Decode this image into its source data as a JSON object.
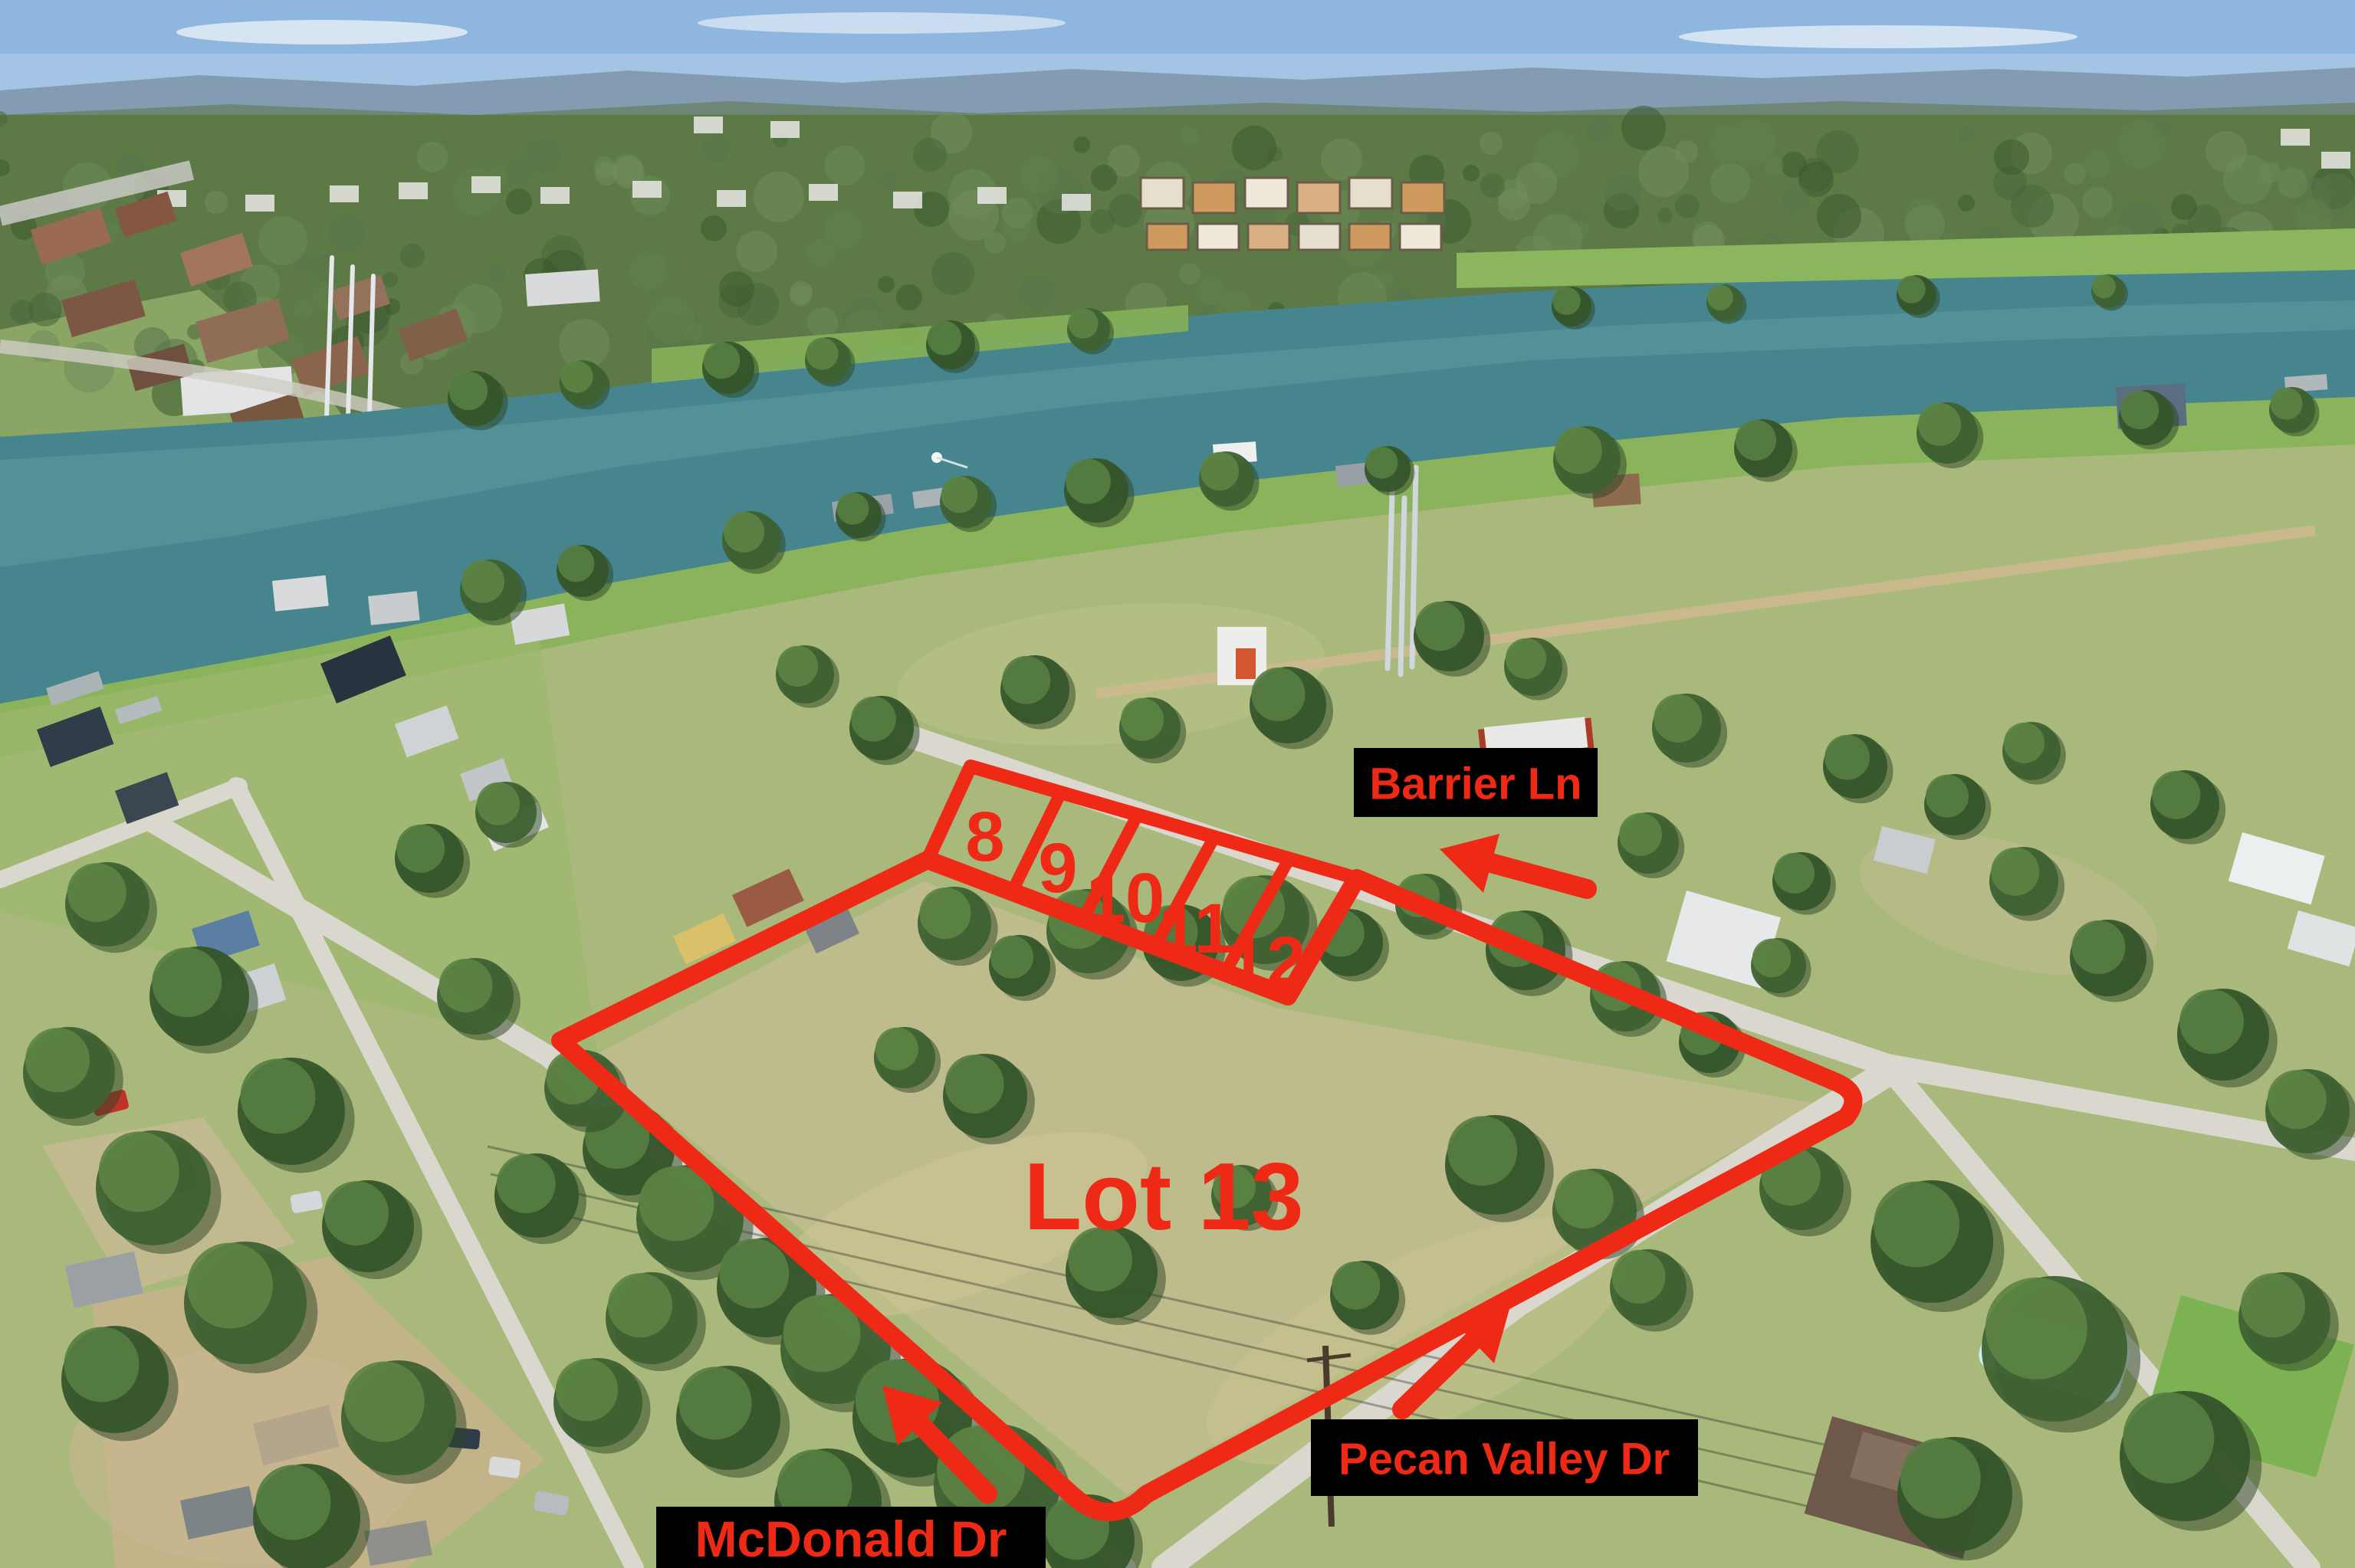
{
  "annotations": {
    "colors": {
      "accent_red": "#ee2a16",
      "label_background": "#000000"
    },
    "numbered_lots": [
      {
        "label": "8"
      },
      {
        "label": "9"
      },
      {
        "label": "10"
      },
      {
        "label": "11"
      },
      {
        "label": "12"
      }
    ],
    "main_lot": {
      "label": "Lot 13"
    },
    "streets": [
      {
        "id": "barrier-ln",
        "label": "Barrier Ln"
      },
      {
        "id": "pecan-valley-dr",
        "label": "Pecan Valley Dr"
      },
      {
        "id": "mcdonald-dr",
        "label": "McDonald Dr"
      }
    ]
  }
}
